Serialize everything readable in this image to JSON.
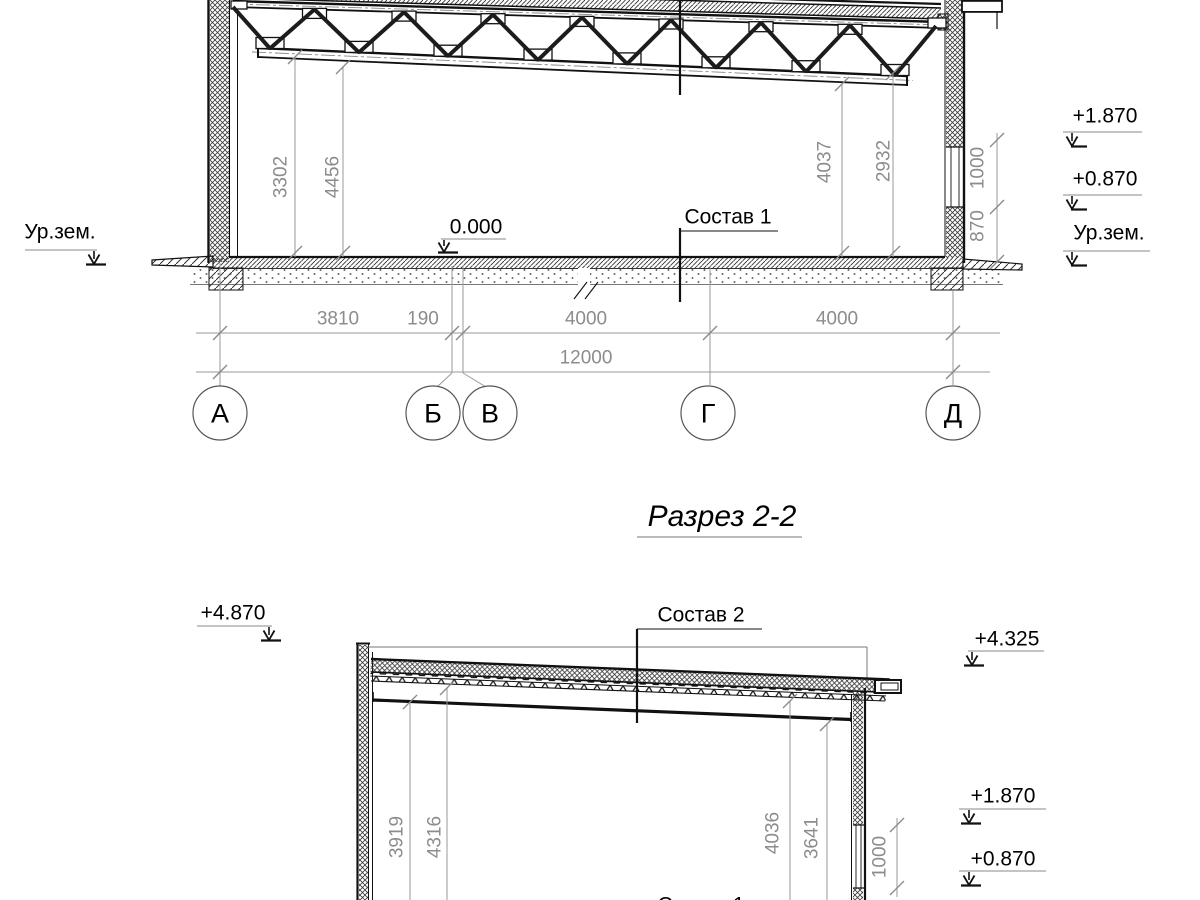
{
  "title": "Разрез 2-2",
  "section1": {
    "ground_left": "Ур.зем.",
    "zero_mark": "0.000",
    "composition": "Состав 1",
    "dims_vertical": {
      "left1": "3302",
      "left2": "4456",
      "right1": "4037",
      "right2": "2932",
      "wall_upper": "1000",
      "wall_lower": "870"
    },
    "levels_right": {
      "l1": "+1.870",
      "l2": "+0.870",
      "ground": "Ур.зем."
    },
    "dims_bottom": {
      "d1": "3810",
      "d2": "190",
      "d3": "4000",
      "d4": "4000",
      "total": "12000"
    },
    "axes": {
      "a1": "А",
      "a2": "Б",
      "a3": "В",
      "a4": "Г",
      "a5": "Д"
    }
  },
  "section2": {
    "level_top_left": "+4.870",
    "composition_roof": "Состав 2",
    "level_top_right": "+4.325",
    "dims_vertical": {
      "left1": "3919",
      "left2": "4316",
      "right1": "4036",
      "right2": "3641",
      "wall": "1000"
    },
    "levels_right": {
      "l1": "+1.870",
      "l2": "+0.870"
    },
    "composition_floor": "Состав 1"
  },
  "colors": {
    "line": "#111111",
    "dim": "#8c8c8c"
  }
}
